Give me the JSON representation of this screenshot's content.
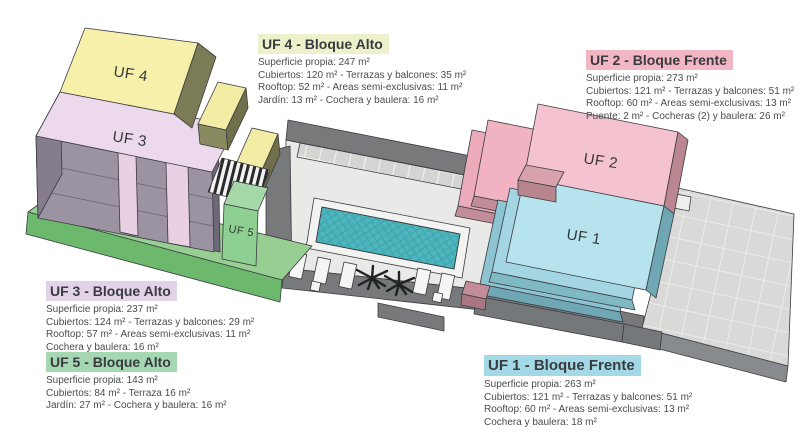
{
  "colors": {
    "uf1": "#a3d9e6",
    "uf2": "#f3b6c4",
    "uf3": "#e2d3e8",
    "uf4": "#edf0ca",
    "uf5": "#a5d7b2",
    "uf1_roof": "#b6e3ee",
    "uf2_roof": "#f5c3cf",
    "uf3_roof": "#ecdaec",
    "uf4_roof": "#f6f0ab",
    "uf5_roof": "#8ecf92",
    "pool_water": "#4fb5bd"
  },
  "site_plan": {
    "unit_labels": {
      "uf1": "UF 1",
      "uf2": "UF 2",
      "uf3": "UF 3",
      "uf4": "UF 4",
      "uf5": "UF 5"
    }
  },
  "info_panels": {
    "uf4": {
      "title": "UF 4 - Bloque Alto",
      "lines": [
        "Superficie propia: 247 m²",
        "Cubiertos: 120 m² - Terrazas y balcones: 35 m²",
        "Rooftop: 52 m² - Areas semi-exclusivas: 11 m²",
        "Jardín: 13 m² - Cochera y baulera: 16 m²"
      ]
    },
    "uf2": {
      "title": "UF 2 - Bloque Frente",
      "lines": [
        "Superficie propia: 273 m²",
        "Cubiertos: 121 m² - Terrazas y balcones: 51 m²",
        "Rooftop: 60 m² - Areas semi-exclusivas: 13 m²",
        "Puente: 2 m² - Cocheras (2) y baulera: 26 m²"
      ]
    },
    "uf3": {
      "title": "UF 3 - Bloque Alto",
      "lines": [
        "Superficie propia: 237 m²",
        "Cubiertos: 124 m² - Terrazas y balcones: 29 m²",
        "Rooftop: 57 m² - Areas semi-exclusivas: 11 m²",
        "Cochera y baulera: 16 m²"
      ]
    },
    "uf5": {
      "title": "UF 5 - Bloque Alto",
      "lines": [
        "Superficie propia: 143 m²",
        "Cubiertos: 84 m² - Terraza 16 m²",
        "Jardín: 27 m² - Cochera y baulera: 16 m²"
      ]
    },
    "uf1": {
      "title": "UF 1 - Bloque Frente",
      "lines": [
        "Superficie propia: 263 m²",
        "Cubiertos: 121 m² - Terrazas y balcones: 51 m²",
        "Rooftop: 60 m² - Areas semi-exclusivas: 13 m²",
        "Cochera y baulera: 18 m²"
      ]
    }
  }
}
